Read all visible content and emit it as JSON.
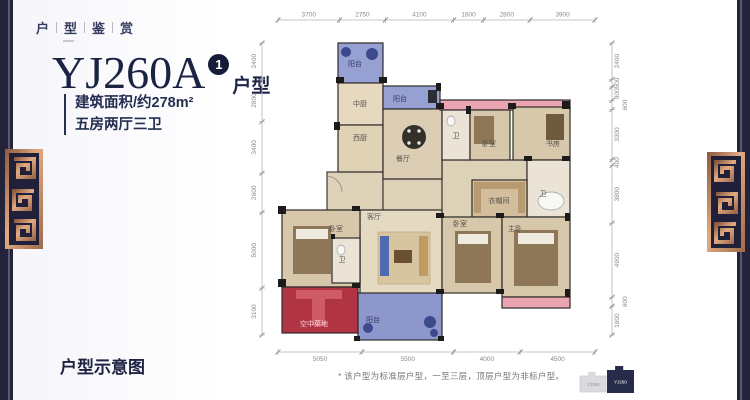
{
  "header": {
    "title_chars": "户型鉴赏"
  },
  "title": {
    "model": "YJ260A",
    "badge": "1",
    "suffix": "户型"
  },
  "specs": {
    "area": "建筑面积/约278m²",
    "layout": "五房两厅三卫"
  },
  "footer": {
    "label": "户型示意图",
    "disclaimer": "* 该户型为标准层户型，一至三层，顶层户型为非标户型。"
  },
  "colors": {
    "navy_text": "#1b2342",
    "edge_bar": "#23233a",
    "copper": "#c8895f",
    "balcony_blue": "#96a0d2",
    "garden_red": "#b13444",
    "wardrobe_pink": "#eba4b2"
  },
  "keyplan": {
    "buildings": [
      {
        "label": "YJ190",
        "x": 580,
        "y": 372,
        "w": 26,
        "h": 20,
        "fill": "#dadae0",
        "text_color": "#8e8e98",
        "highlight": false
      },
      {
        "label": "YJ260",
        "x": 607,
        "y": 366,
        "w": 27,
        "h": 27,
        "fill": "#272b4a",
        "text_color": "#ffffff",
        "highlight": true
      }
    ]
  },
  "floorplan": {
    "style": {
      "wall": "#2e2b28",
      "wall_dark": "#1d1b19",
      "hall_fill": "#ddd1b8",
      "dim_line": "#b5b5b5",
      "dim_text": "#8a8a8a",
      "label": "#55524e"
    },
    "halls": [
      {
        "x": 327,
        "y": 172,
        "w": 56,
        "h": 38
      },
      {
        "x": 383,
        "y": 179,
        "w": 59,
        "h": 31
      },
      {
        "x": 442,
        "y": 160,
        "w": 85,
        "h": 57
      }
    ],
    "rooms": [
      {
        "name": "balcony-top",
        "label": "阳台",
        "x": 338,
        "y": 43,
        "w": 45,
        "h": 40,
        "fill": "#96a0d2",
        "lc": "#2f3860",
        "lx": 355,
        "ly": 66
      },
      {
        "name": "kitchen-chinese",
        "label": "中厨",
        "x": 338,
        "y": 83,
        "w": 45,
        "h": 42,
        "fill": "#e6d9bf",
        "lx": 360,
        "ly": 106
      },
      {
        "name": "balcony-middle",
        "label": "阳台",
        "x": 383,
        "y": 86,
        "w": 57,
        "h": 23,
        "fill": "#96a0d2",
        "lc": "#2f3860",
        "lx": 400,
        "ly": 101
      },
      {
        "name": "kitchen-west",
        "label": "西厨",
        "x": 338,
        "y": 125,
        "w": 45,
        "h": 47,
        "fill": "#e0d2b5",
        "lx": 360,
        "ly": 140
      },
      {
        "name": "dining-room",
        "label": "餐厅",
        "x": 383,
        "y": 109,
        "w": 59,
        "h": 70,
        "fill": "#dccEB4",
        "lx": 403,
        "ly": 161
      },
      {
        "name": "wardrobe-strip-top",
        "label": "",
        "x": 440,
        "y": 100,
        "w": 130,
        "h": 10,
        "fill": "#eba4b2",
        "lx": 0,
        "ly": 0
      },
      {
        "name": "bath-1",
        "label": "卫",
        "x": 442,
        "y": 110,
        "w": 28,
        "h": 50,
        "fill": "#eae3d6",
        "lx": 456,
        "ly": 138
      },
      {
        "name": "bedroom-1",
        "label": "卧室",
        "x": 470,
        "y": 110,
        "w": 40,
        "h": 50,
        "fill": "#d8c8ab",
        "lx": 489,
        "ly": 146
      },
      {
        "name": "study",
        "label": "书房",
        "x": 513,
        "y": 107,
        "w": 57,
        "h": 53,
        "fill": "#d8c8ab",
        "lx": 553,
        "ly": 146
      },
      {
        "name": "bath-2",
        "label": "卫",
        "x": 527,
        "y": 160,
        "w": 43,
        "h": 57,
        "fill": "#eae3d6",
        "lx": 543,
        "ly": 196
      },
      {
        "name": "closet",
        "label": "衣帽间",
        "x": 472,
        "y": 180,
        "w": 55,
        "h": 37,
        "fill": "#d2bd9c",
        "lx": 499,
        "ly": 203
      },
      {
        "name": "living-room",
        "label": "客厅",
        "x": 360,
        "y": 210,
        "w": 82,
        "h": 87,
        "fill": "#e4dac2",
        "lx": 374,
        "ly": 219
      },
      {
        "name": "bedroom-2",
        "label": "卧室",
        "x": 282,
        "y": 210,
        "w": 78,
        "h": 77,
        "fill": "#d8c8ab",
        "lx": 336,
        "ly": 231
      },
      {
        "name": "bath-3",
        "label": "卫",
        "x": 332,
        "y": 238,
        "w": 28,
        "h": 45,
        "fill": "#eae3d6",
        "lx": 342,
        "ly": 262
      },
      {
        "name": "bedroom-3",
        "label": "卧室",
        "x": 442,
        "y": 217,
        "w": 60,
        "h": 76,
        "fill": "#d8c8ab",
        "lx": 460,
        "ly": 226
      },
      {
        "name": "master-bedroom",
        "label": "主卧",
        "x": 502,
        "y": 217,
        "w": 68,
        "h": 80,
        "fill": "#d8c8ab",
        "lx": 515,
        "ly": 231
      },
      {
        "name": "sky-garden",
        "label": "空中菜地",
        "x": 282,
        "y": 287,
        "w": 76,
        "h": 46,
        "fill": "#b13444",
        "lc": "#f4d8d8",
        "lx": 314,
        "ly": 326
      },
      {
        "name": "balcony-bottom",
        "label": "阳台",
        "x": 358,
        "y": 293,
        "w": 84,
        "h": 47,
        "fill": "#8d97cb",
        "lc": "#2f3860",
        "lx": 373,
        "ly": 322
      },
      {
        "name": "wardrobe-strip-bottom",
        "label": "",
        "x": 502,
        "y": 297,
        "w": 68,
        "h": 11,
        "fill": "#eba4b2",
        "lx": 0,
        "ly": 0
      }
    ],
    "walls": [
      [
        336,
        77,
        8,
        6
      ],
      [
        379,
        77,
        8,
        6
      ],
      [
        436,
        83,
        5,
        8
      ],
      [
        334,
        122,
        6,
        8
      ],
      [
        436,
        103,
        8,
        6
      ],
      [
        466,
        106,
        5,
        8
      ],
      [
        508,
        103,
        8,
        6
      ],
      [
        562,
        101,
        8,
        8
      ],
      [
        524,
        156,
        8,
        5
      ],
      [
        562,
        156,
        8,
        5
      ],
      [
        278,
        206,
        8,
        8
      ],
      [
        352,
        206,
        8,
        5
      ],
      [
        436,
        213,
        8,
        5
      ],
      [
        496,
        213,
        8,
        5
      ],
      [
        565,
        213,
        5,
        8
      ],
      [
        278,
        279,
        8,
        8
      ],
      [
        330,
        234,
        5,
        5
      ],
      [
        352,
        283,
        8,
        5
      ],
      [
        436,
        289,
        8,
        5
      ],
      [
        496,
        289,
        8,
        5
      ],
      [
        565,
        289,
        5,
        8
      ],
      [
        354,
        336,
        6,
        5
      ],
      [
        438,
        336,
        6,
        5
      ]
    ],
    "furniture": [
      {
        "type": "circle",
        "cx": 414,
        "cy": 137,
        "r": 12,
        "fill": "#33302c"
      },
      {
        "type": "circle",
        "cx": 409,
        "cy": 131,
        "r": 1.7,
        "fill": "#e8e8e4"
      },
      {
        "type": "circle",
        "cx": 419,
        "cy": 131,
        "r": 1.7,
        "fill": "#e8e8e4"
      },
      {
        "type": "circle",
        "cx": 409,
        "cy": 143,
        "r": 1.7,
        "fill": "#e8e8e4"
      },
      {
        "type": "circle",
        "cx": 419,
        "cy": 143,
        "r": 1.7,
        "fill": "#e8e8e4"
      },
      {
        "type": "rect",
        "x": 378,
        "y": 232,
        "w": 52,
        "h": 52,
        "fill": "#d6c59e",
        "stroke": "#bda77d"
      },
      {
        "type": "rect",
        "x": 394,
        "y": 250,
        "w": 18,
        "h": 13,
        "fill": "#6b4f33"
      },
      {
        "type": "rect",
        "x": 380,
        "y": 236,
        "w": 9,
        "h": 40,
        "fill": "#4f6bb0"
      },
      {
        "type": "rect",
        "x": 419,
        "y": 236,
        "w": 9,
        "h": 40,
        "fill": "#c2995f"
      },
      {
        "type": "rect",
        "x": 293,
        "y": 226,
        "w": 38,
        "h": 48,
        "fill": "#8d7757"
      },
      {
        "type": "rect",
        "x": 296,
        "y": 229,
        "w": 32,
        "h": 10,
        "fill": "#efeae0"
      },
      {
        "type": "rect",
        "x": 455,
        "y": 231,
        "w": 36,
        "h": 52,
        "fill": "#8d7757"
      },
      {
        "type": "rect",
        "x": 458,
        "y": 234,
        "w": 30,
        "h": 10,
        "fill": "#efeae0"
      },
      {
        "type": "rect",
        "x": 514,
        "y": 230,
        "w": 44,
        "h": 56,
        "fill": "#8d7757"
      },
      {
        "type": "rect",
        "x": 518,
        "y": 233,
        "w": 36,
        "h": 11,
        "fill": "#efeae0"
      },
      {
        "type": "rect",
        "x": 474,
        "y": 116,
        "w": 20,
        "h": 28,
        "fill": "#8d7757"
      },
      {
        "type": "rect",
        "x": 546,
        "y": 114,
        "w": 18,
        "h": 26,
        "fill": "#6f5a3e"
      },
      {
        "type": "ellipse",
        "cx": 551,
        "cy": 201,
        "rx": 13,
        "ry": 9,
        "fill": "#f8f8f5",
        "stroke": "#9a9a9a"
      },
      {
        "type": "ellipse",
        "cx": 451,
        "cy": 121,
        "rx": 4,
        "ry": 5,
        "fill": "#f6f6f3",
        "stroke": "#a0a0a0"
      },
      {
        "type": "ellipse",
        "cx": 341,
        "cy": 250,
        "rx": 4,
        "ry": 5,
        "fill": "#f6f6f3",
        "stroke": "#a0a0a0"
      },
      {
        "type": "rect",
        "x": 296,
        "y": 290,
        "w": 46,
        "h": 9,
        "fill": "#cf5b69"
      },
      {
        "type": "rect",
        "x": 312,
        "y": 290,
        "w": 13,
        "h": 36,
        "fill": "#cf5b69"
      },
      {
        "type": "circle",
        "cx": 346,
        "cy": 52,
        "r": 5,
        "fill": "#3c4a8c"
      },
      {
        "type": "circle",
        "cx": 372,
        "cy": 54,
        "r": 6,
        "fill": "#3c4a8c"
      },
      {
        "type": "rect",
        "x": 428,
        "y": 90,
        "w": 9,
        "h": 13,
        "fill": "#2c2c34"
      },
      {
        "type": "circle",
        "cx": 368,
        "cy": 328,
        "r": 5,
        "fill": "#3c4a8c"
      },
      {
        "type": "circle",
        "cx": 430,
        "cy": 322,
        "r": 6,
        "fill": "#3c4a8c"
      },
      {
        "type": "circle",
        "cx": 434,
        "cy": 333,
        "r": 4,
        "fill": "#3c4a8c"
      },
      {
        "type": "rect",
        "x": 474,
        "y": 182,
        "w": 51,
        "h": 7,
        "fill": "#b99b71"
      },
      {
        "type": "rect",
        "x": 474,
        "y": 189,
        "w": 7,
        "h": 24,
        "fill": "#b99b71"
      },
      {
        "type": "rect",
        "x": 518,
        "y": 189,
        "w": 7,
        "h": 24,
        "fill": "#b99b71"
      },
      {
        "type": "path",
        "d": "M326,176 A16,16 0 0 1 342,192",
        "stroke": "#8a8a8a"
      }
    ],
    "dimensions": {
      "top": {
        "y": 20,
        "x0": 278,
        "x1": 595,
        "values": [
          3700,
          2750,
          4100,
          1800,
          2800,
          3900
        ]
      },
      "bottom": {
        "y": 352,
        "x0": 278,
        "x1": 595,
        "values": [
          5050,
          5500,
          4000,
          4500
        ]
      },
      "left": {
        "x": 262,
        "y0": 43,
        "y1": 335,
        "values": [
          2400,
          2800,
          3400,
          2600,
          5000,
          3100
        ]
      },
      "right": {
        "x": 612,
        "y0": 43,
        "y1": 335,
        "values": [
          2400,
          500,
          900,
          600,
          3300,
          400,
          3800,
          4900,
          600,
          1900
        ]
      }
    }
  }
}
